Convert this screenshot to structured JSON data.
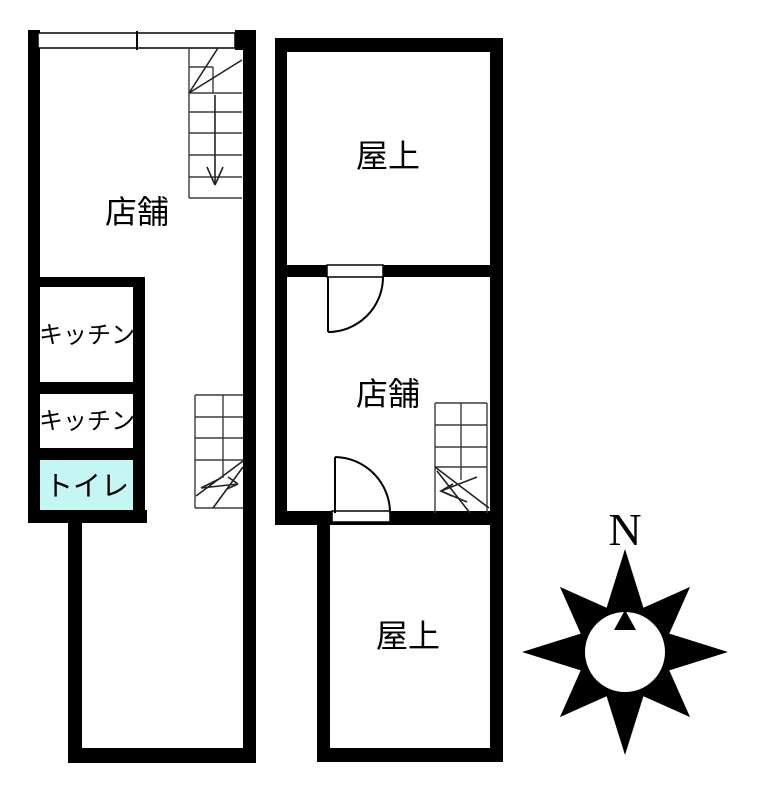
{
  "page": {
    "background": "#ffffff",
    "type": "floor-plan"
  },
  "colors": {
    "wall": "#000000",
    "stair_line": "#3c3c3c",
    "toilet_fill": "#c4f6f3"
  },
  "rooms": {
    "shop_left": "店舗",
    "kitchen1": "キッチン",
    "kitchen2": "キッチン",
    "toilet": "トイレ",
    "rooftop_top": "屋上",
    "shop_right": "店舗",
    "rooftop_bottom": "屋上"
  },
  "compass": {
    "north_label": "N"
  }
}
